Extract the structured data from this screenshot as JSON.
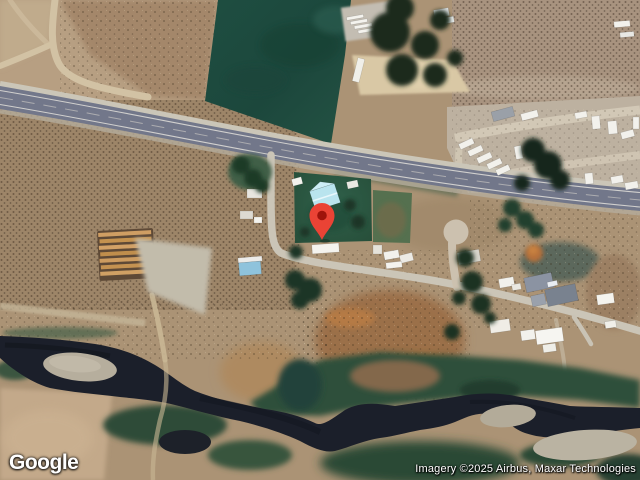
{
  "map": {
    "type": "satellite",
    "features": [
      "highway",
      "irrigated field",
      "rural homes",
      "rv lot",
      "dirt roads",
      "river",
      "gravel bars",
      "scrubland"
    ]
  },
  "marker": {
    "pin_color": "#EA4335",
    "pin_inner_color": "#9E130B",
    "position_px": {
      "x": 322,
      "y": 240
    }
  },
  "logo": {
    "text": "Google"
  },
  "attribution": {
    "text": "Imagery ©2025 Airbus, Maxar Technologies"
  },
  "colors": {
    "terrain_tan": "#ab9375",
    "field_green": "#1d4b3f",
    "tree_green": "#1b2f20",
    "highway_gray": "#72778a",
    "dirt_road": "#cdbfa5",
    "river_dark": "#1b1f2a",
    "gravel_bar": "#b6ae9d",
    "lawn_green": "#2b5a41",
    "cyan_roof": "#b9e4ee"
  }
}
